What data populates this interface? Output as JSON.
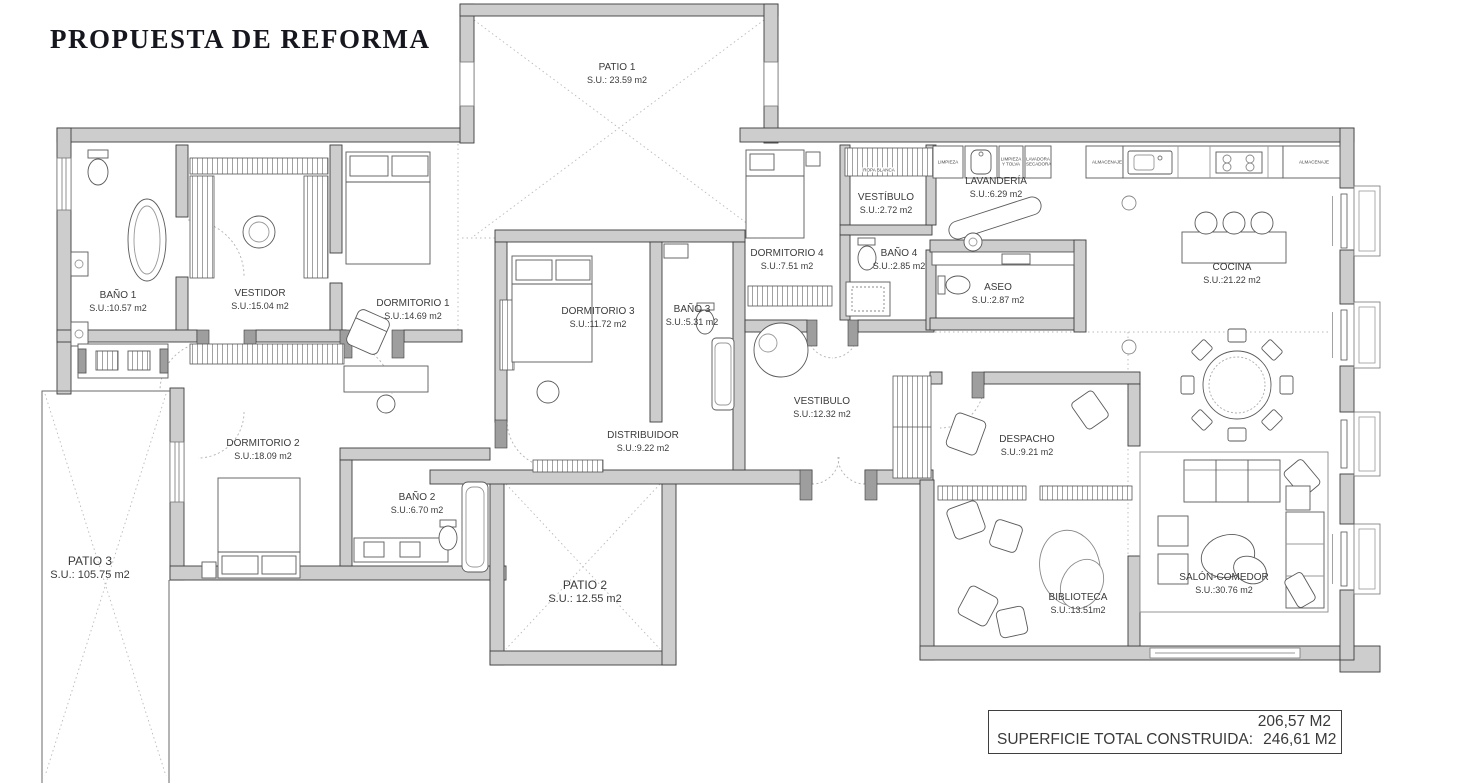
{
  "title": "PROPUESTA DE REFORMA",
  "rooms": [
    {
      "name": "PATIO 1",
      "area": "S.U.: 23.59 m2"
    },
    {
      "name": "BAÑO 1",
      "area": "S.U.:10.57 m2"
    },
    {
      "name": "VESTIDOR",
      "area": "S.U.:15.04 m2"
    },
    {
      "name": "DORMITORIO 1",
      "area": "S.U.:14.69 m2"
    },
    {
      "name": "DORMITORIO 3",
      "area": "S.U.:11.72 m2"
    },
    {
      "name": "BAÑO 3",
      "area": "S.U.:5.31 m2"
    },
    {
      "name": "DORMITORIO 4",
      "area": "S.U.:7.51 m2"
    },
    {
      "name": "VESTÍBULO",
      "area": "S.U.:2.72 m2"
    },
    {
      "name": "BAÑO 4",
      "area": "S.U.:2.85 m2"
    },
    {
      "name": "LAVANDERÍA",
      "area": "S.U.:6.29 m2"
    },
    {
      "name": "ASEO",
      "area": "S.U.:2.87 m2"
    },
    {
      "name": "COCINA",
      "area": "S.U.:21.22 m2"
    },
    {
      "name": "VESTIBULO",
      "area": "S.U.:12.32 m2"
    },
    {
      "name": "DISTRIBUIDOR",
      "area": "S.U.:9.22 m2"
    },
    {
      "name": "DORMITORIO 2",
      "area": "S.U.:18.09 m2"
    },
    {
      "name": "BAÑO 2",
      "area": "S.U.:6.70 m2"
    },
    {
      "name": "PATIO 2",
      "area": "S.U.: 12.55 m2"
    },
    {
      "name": "PATIO 3",
      "area": "S.U.: 105.75 m2"
    },
    {
      "name": "DESPACHO",
      "area": "S.U.:9.21 m2"
    },
    {
      "name": "BIBLIOTECA",
      "area": "S.U.:13.51m2"
    },
    {
      "name": "SALÓN-COMEDOR",
      "area": "S.U.:30.76 m2"
    }
  ],
  "cabinet_labels": {
    "limpieza": "LIMPIEZA",
    "limpieza_tolva": "LIMPIEZA Y TOLVA",
    "lavadora_secadora": "LAVADORA SECADORA",
    "almacenaje_left": "ALMACENAJE",
    "almacenaje_right": "ALMACENAJE",
    "ropa_blanca": "ROPA BLANCA"
  },
  "summary": {
    "reformed_area": "206,57 M2",
    "total_label": "SUPERFICIE TOTAL CONSTRUIDA:",
    "total_area": "246,61 M2"
  },
  "colors": {
    "wall": "#cdcdcd",
    "line": "#3c3c3c",
    "furniture": "#5a5a5a",
    "dotted": "#b4b4b4"
  }
}
